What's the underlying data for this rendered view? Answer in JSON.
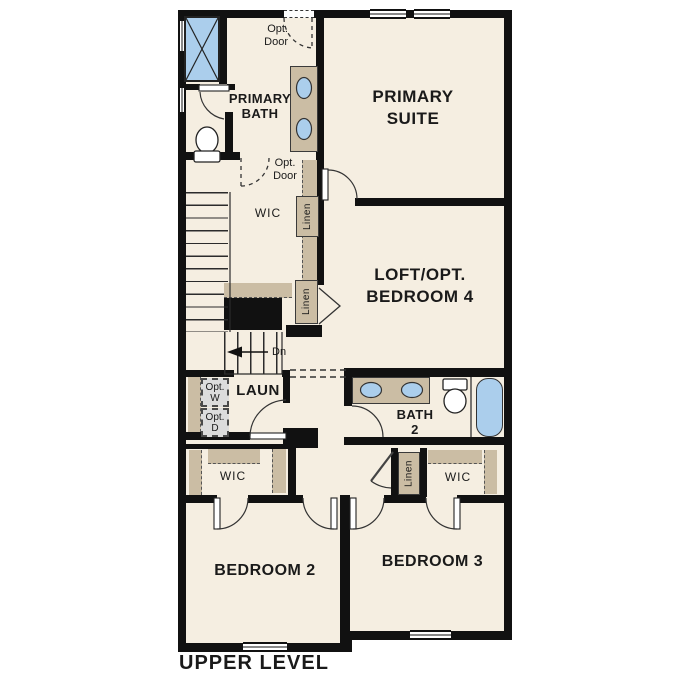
{
  "plan": {
    "title": "UPPER LEVEL",
    "rooms": {
      "primary_suite": {
        "line1": "PRIMARY",
        "line2": "SUITE"
      },
      "primary_bath": {
        "line1": "PRIMARY",
        "line2": "BATH"
      },
      "loft": {
        "line1": "LOFT/OPT.",
        "line2": "BEDROOM 4"
      },
      "wic_primary": {
        "label": "WIC"
      },
      "laundry": {
        "label": "LAUN"
      },
      "bath2": {
        "line1": "BATH",
        "line2": "2"
      },
      "wic_bedroom2": {
        "label": "WIC"
      },
      "wic_bedroom3": {
        "label": "WIC"
      },
      "bedroom2": {
        "label": "BEDROOM 2"
      },
      "bedroom3": {
        "label": "BEDROOM 3"
      }
    },
    "closets": {
      "linen_upper": "Linen",
      "linen_mid": "Linen",
      "linen_lower": "Linen"
    },
    "annotations": {
      "opt_door_upper": {
        "line1": "Opt.",
        "line2": "Door"
      },
      "opt_door_wic": {
        "line1": "Opt.",
        "line2": "Door"
      },
      "opt_washer": {
        "line1": "Opt.",
        "line2": "W"
      },
      "opt_dryer": {
        "line1": "Opt.",
        "line2": "D"
      },
      "stair_down": "Dn"
    },
    "colors": {
      "floor": "#f5eee1",
      "wall": "#111111",
      "cabinet_tan": "#cbbda4",
      "fixture_blue": "#abceec",
      "appliance_gray": "#dcdcdc"
    }
  }
}
